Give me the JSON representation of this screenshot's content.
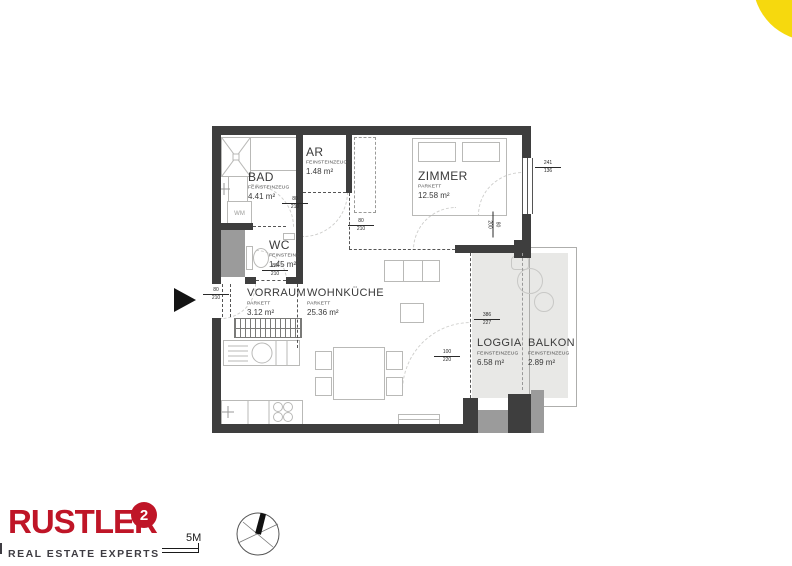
{
  "page": {
    "background": "#ffffff",
    "accent_yellow": "#f6d90e"
  },
  "floorplan": {
    "rooms": [
      {
        "id": "bad",
        "name": "BAD",
        "finish": "FEINSTEINZEUG",
        "area": "4.41 m²"
      },
      {
        "id": "ar",
        "name": "AR",
        "finish": "FEINSTEINZEUG",
        "area": "1.48 m²"
      },
      {
        "id": "zimmer",
        "name": "ZIMMER",
        "finish": "PARKETT",
        "area": "12.58 m²"
      },
      {
        "id": "wc",
        "name": "WC",
        "finish": "FEINSTEINZ.",
        "area": "1.45 m²"
      },
      {
        "id": "vorraum",
        "name": "VORRAUM",
        "finish": "PARKETT",
        "area": "3.12 m²"
      },
      {
        "id": "wohnkueche",
        "name": "WOHNKÜCHE",
        "finish": "PARKETT",
        "area": "25.36 m²"
      },
      {
        "id": "loggia",
        "name": "LOGGIA",
        "finish": "FEINSTEINZEUG",
        "area": "6.58 m²"
      },
      {
        "id": "balkon",
        "name": "BALKON",
        "finish": "FEINSTEINZEUG",
        "area": "2.89 m²"
      }
    ],
    "labels": {
      "washing_machine": "WM"
    },
    "dimensions": [
      {
        "id": "entry-door",
        "top": "80",
        "bottom": "210"
      },
      {
        "id": "bad-door",
        "top": "80",
        "bottom": "210"
      },
      {
        "id": "wc-door",
        "top": "80",
        "bottom": "210"
      },
      {
        "id": "ar-door",
        "top": "80",
        "bottom": "210"
      },
      {
        "id": "zimmer-door",
        "top": "80",
        "bottom": "200"
      },
      {
        "id": "zimmer-window",
        "top": "241",
        "bottom": "136"
      },
      {
        "id": "loggia-opening",
        "top": "386",
        "bottom": "227"
      },
      {
        "id": "balkon-door",
        "top": "100",
        "bottom": "220"
      }
    ],
    "colors": {
      "wall": "#3e3e3e",
      "secondary_wall": "#9b9b9b",
      "outdoor_floor": "#e8e8e6",
      "furniture_line": "#b9b9b7"
    }
  },
  "footer": {
    "brand": {
      "name": "RUSTLER",
      "superscript": "2",
      "tagline": "REAL ESTATE EXPERTS",
      "color": "#bf1527",
      "tagline_color": "#3e3c42"
    },
    "scale": {
      "label": "5M"
    },
    "compass": "north-arrow"
  }
}
